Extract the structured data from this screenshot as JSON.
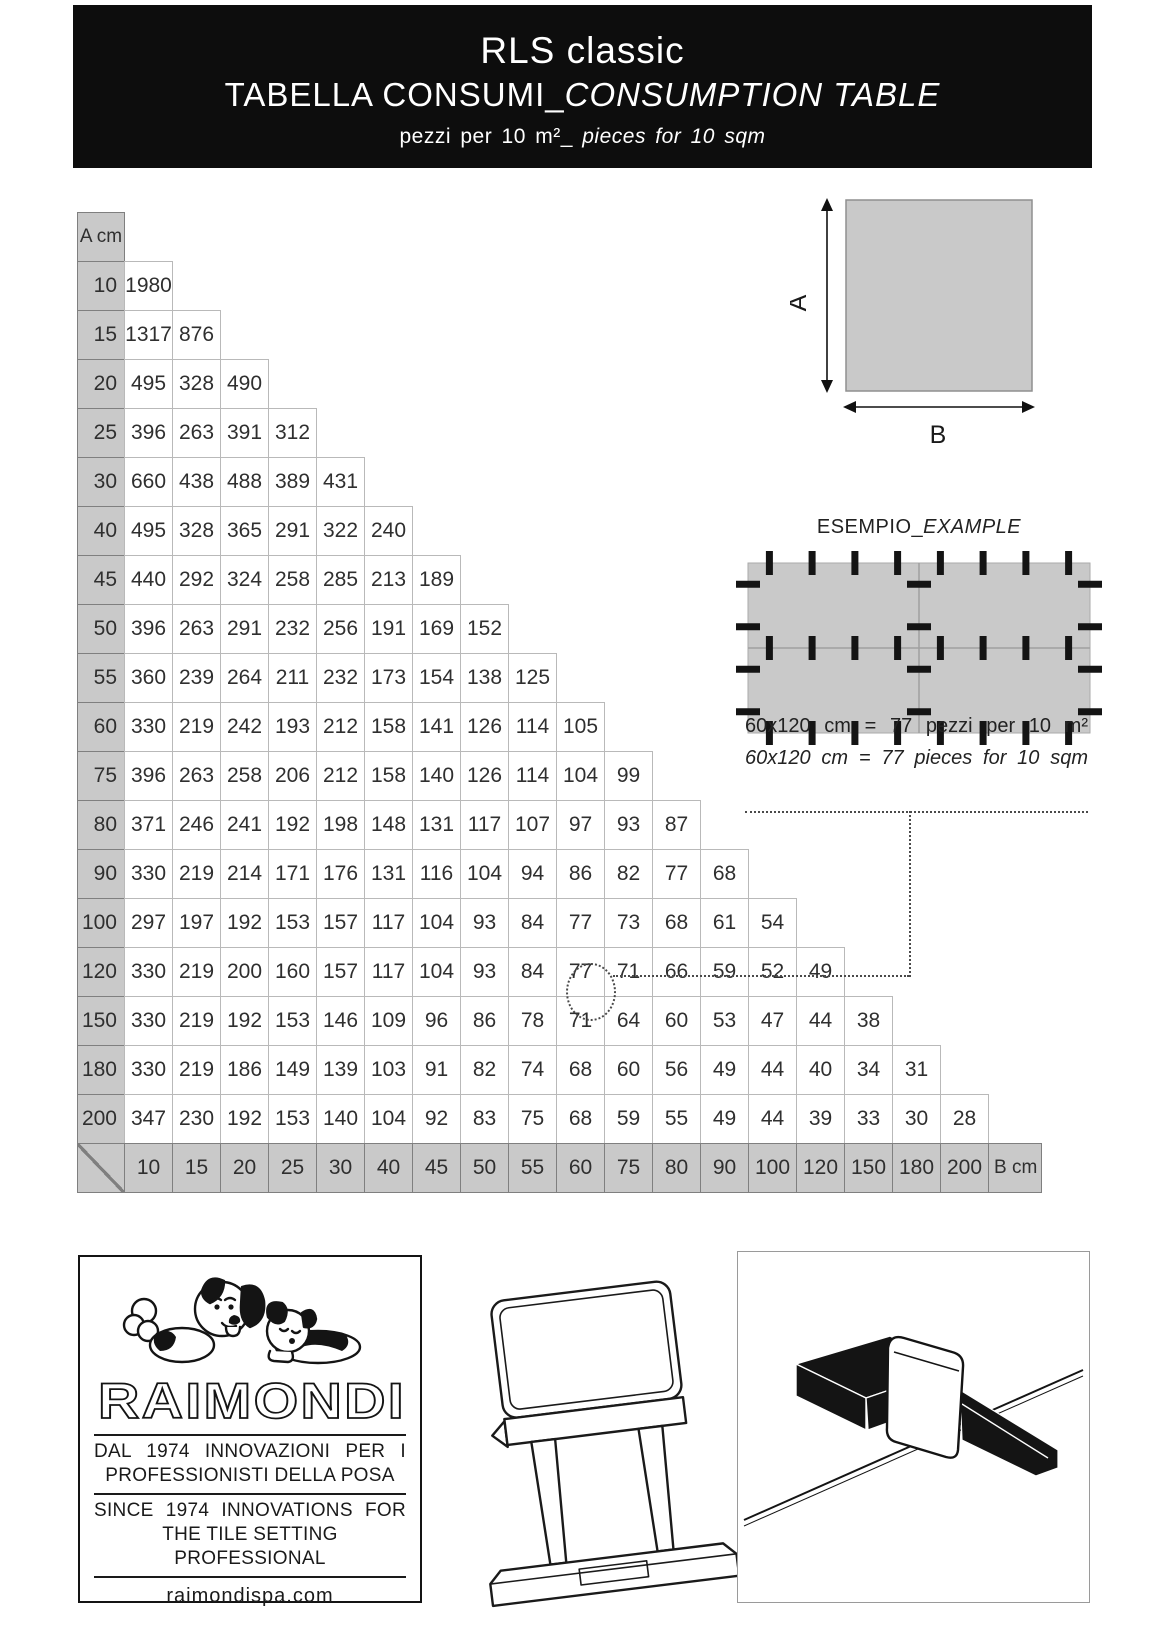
{
  "header": {
    "title": "RLS classic",
    "subtitle_regular": "TABELLA CONSUMI_",
    "subtitle_italic": "CONSUMPTION TABLE",
    "note_regular": "pezzi per 10 m²_ ",
    "note_italic": "pieces for 10 sqm"
  },
  "table": {
    "corner_label": "A cm",
    "b_label": "B cm",
    "col_headers": [
      "10",
      "15",
      "20",
      "25",
      "30",
      "40",
      "45",
      "50",
      "55",
      "60",
      "75",
      "80",
      "90",
      "100",
      "120",
      "150",
      "180",
      "200"
    ],
    "rows": [
      {
        "a": "10",
        "values": [
          1980
        ]
      },
      {
        "a": "15",
        "values": [
          1317,
          876
        ]
      },
      {
        "a": "20",
        "values": [
          495,
          328,
          490
        ]
      },
      {
        "a": "25",
        "values": [
          396,
          263,
          391,
          312
        ]
      },
      {
        "a": "30",
        "values": [
          660,
          438,
          488,
          389,
          431
        ]
      },
      {
        "a": "40",
        "values": [
          495,
          328,
          365,
          291,
          322,
          240
        ]
      },
      {
        "a": "45",
        "values": [
          440,
          292,
          324,
          258,
          285,
          213,
          189
        ]
      },
      {
        "a": "50",
        "values": [
          396,
          263,
          291,
          232,
          256,
          191,
          169,
          152
        ]
      },
      {
        "a": "55",
        "values": [
          360,
          239,
          264,
          211,
          232,
          173,
          154,
          138,
          125
        ]
      },
      {
        "a": "60",
        "values": [
          330,
          219,
          242,
          193,
          212,
          158,
          141,
          126,
          114,
          105
        ]
      },
      {
        "a": "75",
        "values": [
          396,
          263,
          258,
          206,
          212,
          158,
          140,
          126,
          114,
          104,
          99
        ]
      },
      {
        "a": "80",
        "values": [
          371,
          246,
          241,
          192,
          198,
          148,
          131,
          117,
          107,
          97,
          93,
          87
        ]
      },
      {
        "a": "90",
        "values": [
          330,
          219,
          214,
          171,
          176,
          131,
          116,
          104,
          94,
          86,
          82,
          77,
          68
        ]
      },
      {
        "a": "100",
        "values": [
          297,
          197,
          192,
          153,
          157,
          117,
          104,
          93,
          84,
          77,
          73,
          68,
          61,
          54
        ]
      },
      {
        "a": "120",
        "values": [
          330,
          219,
          200,
          160,
          157,
          117,
          104,
          93,
          84,
          77,
          71,
          66,
          59,
          52,
          49
        ]
      },
      {
        "a": "150",
        "values": [
          330,
          219,
          192,
          153,
          146,
          109,
          96,
          86,
          78,
          71,
          64,
          60,
          53,
          47,
          44,
          38
        ]
      },
      {
        "a": "180",
        "values": [
          330,
          219,
          186,
          149,
          139,
          103,
          91,
          82,
          74,
          68,
          60,
          56,
          49,
          44,
          40,
          34,
          31
        ]
      },
      {
        "a": "200",
        "values": [
          347,
          230,
          192,
          153,
          140,
          104,
          92,
          83,
          75,
          68,
          59,
          55,
          49,
          44,
          39,
          33,
          30,
          28
        ]
      }
    ],
    "highlight": {
      "row_a": "120",
      "col_b": "60",
      "value": 77
    }
  },
  "tile_diagram": {
    "label_a": "A",
    "label_b": "B"
  },
  "example": {
    "title_regular": "ESEMPIO_",
    "title_italic": "EXAMPLE",
    "line1": "60x120 cm = 77 pezzi per 10 m²",
    "line2": "60x120 cm = 77 pieces for 10 sqm"
  },
  "footer": {
    "logo_text": "RAIMONDI",
    "tagline_it_line1": "DAL 1974 INNOVAZIONI PER I",
    "tagline_it_line2": "PROFESSIONISTI DELLA POSA",
    "tagline_en_line1": "SINCE 1974 INNOVATIONS FOR",
    "tagline_en_line2": "THE TILE SETTING PROFESSIONAL",
    "website": "raimondispa.com"
  },
  "colors": {
    "banner_bg": "#0d0d0d",
    "header_cell_gray": "#c9c9c9",
    "dark_cell_border": "#7f7f7f",
    "light_cell_border": "#b9b9b9",
    "clip_black": "#141414",
    "dotted_line": "#4a4a4a"
  }
}
